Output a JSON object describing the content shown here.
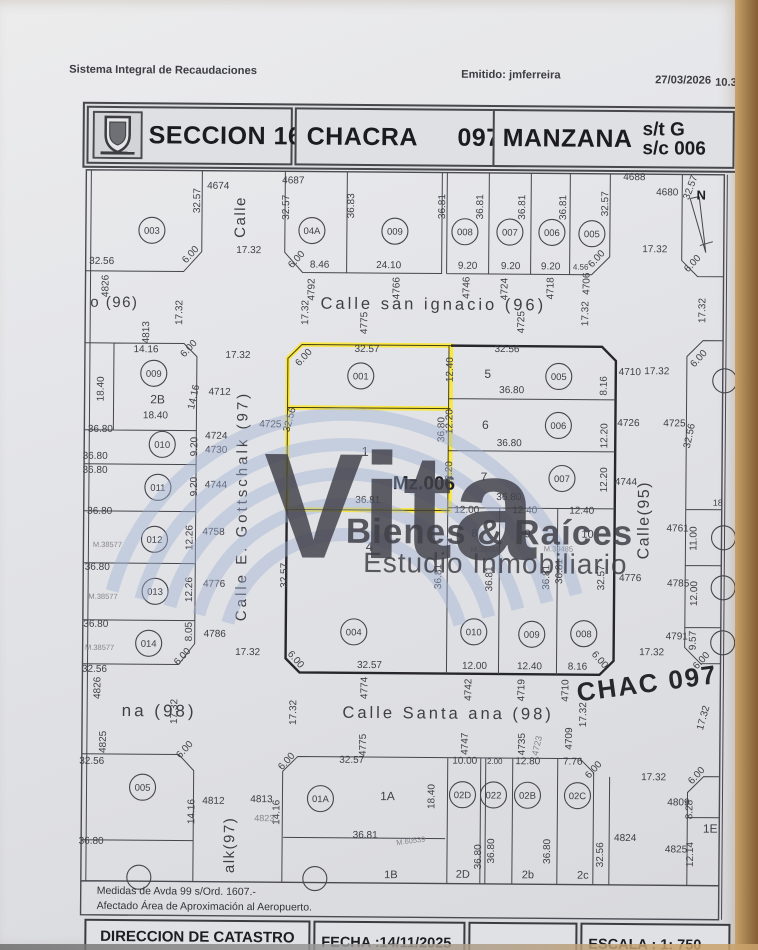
{
  "header": {
    "system": "Sistema Integral de Recaudaciones",
    "emitted": "Emitido: jmferreira",
    "date": "27/03/2026",
    "time": "10.31"
  },
  "title": {
    "seccion_label": "SECCION",
    "seccion_value": "16",
    "chacra_label": "CHACRA",
    "chacra_value": "097",
    "manzana_label": "MANZANA",
    "st": "s/t G",
    "sc": "s/c 006"
  },
  "watermark": {
    "word": "Vita",
    "line1": "Bienes & Raíces",
    "line2": "Estudio Inmobiliario"
  },
  "notes": {
    "line1": "Medidas de Avda 99 s/Ord. 1607.-",
    "line2": "Afectado Área de Aproximación al Aeropuerto."
  },
  "footer": {
    "office": "DIRECCION DE CATASTRO",
    "office_sub": "Información Geográfica",
    "fecha": "FECHA :14/11/2025",
    "escala": "ESCALA :  1:  750"
  },
  "map": {
    "highlight_color": "#ffe818",
    "labels": [
      [
        "32.57",
        198,
        202,
        -90
      ],
      [
        "4674",
        216,
        190
      ],
      [
        "Calle",
        243,
        218,
        -90,
        15,
        "st"
      ],
      [
        "4687",
        291,
        184
      ],
      [
        "32.57",
        287,
        208,
        -90
      ],
      [
        "36.83",
        352,
        206,
        -90
      ],
      [
        "36.81",
        443,
        206,
        -90
      ],
      [
        "36.81",
        481,
        206,
        -90
      ],
      [
        "36.81",
        523,
        206,
        -90
      ],
      [
        "36.81",
        564,
        206,
        -90
      ],
      [
        "32.57",
        606,
        202,
        -90
      ],
      [
        "4688",
        632,
        178
      ],
      [
        "4680",
        665,
        193
      ],
      [
        "N",
        699,
        197,
        0,
        13,
        "b"
      ],
      [
        "32.57",
        691,
        186,
        -70
      ],
      [
        "17.32",
        653,
        250
      ],
      [
        "6.00",
        693,
        263,
        -48
      ],
      [
        "17.32",
        704,
        308,
        -90
      ],
      [
        "6.00",
        191,
        258,
        -48
      ],
      [
        "32.56",
        100,
        266
      ],
      [
        "17.32",
        247,
        254
      ],
      [
        "6.00",
        297,
        262,
        -48
      ],
      [
        "8.46",
        318,
        268
      ],
      [
        "24.10",
        387,
        268
      ],
      [
        "9.20",
        466,
        268
      ],
      [
        "9.20",
        509,
        268
      ],
      [
        "9.20",
        549,
        268
      ],
      [
        "4.56",
        579,
        268,
        0,
        8
      ],
      [
        "6.00",
        597,
        259,
        -48
      ],
      [
        "4826",
        107,
        288,
        -90
      ],
      [
        "o (96)",
        113,
        309,
        0,
        15,
        "st"
      ],
      [
        "17.32",
        181,
        314,
        -90
      ],
      [
        "4792",
        313,
        290,
        -90
      ],
      [
        "17.32",
        307,
        313,
        -90
      ],
      [
        "Calle san ignacio (96)",
        432,
        309,
        0,
        16.5,
        "st2"
      ],
      [
        "4775",
        366,
        323,
        -90
      ],
      [
        "4766",
        398,
        288,
        -90
      ],
      [
        "4746",
        468,
        287,
        -90
      ],
      [
        "4724",
        506,
        288,
        -90
      ],
      [
        "4718",
        552,
        287,
        -90
      ],
      [
        "4706",
        588,
        282,
        -90
      ],
      [
        "17.32",
        587,
        312,
        -90
      ],
      [
        "4725",
        523,
        321,
        -90
      ],
      [
        "14.16",
        145,
        354
      ],
      [
        "17.32",
        237,
        359
      ],
      [
        "4813",
        148,
        334,
        -90
      ],
      [
        "6.00",
        190,
        352,
        -48
      ],
      [
        "6.00",
        305,
        360,
        -48
      ],
      [
        "32.57",
        366,
        352
      ],
      [
        "32.56",
        506,
        351
      ],
      [
        "12.40",
        452,
        369,
        -90
      ],
      [
        "5",
        487,
        377,
        0,
        12
      ],
      [
        "36.80",
        511,
        392
      ],
      [
        "8.16",
        606,
        384,
        -90
      ],
      [
        "4710",
        629,
        373
      ],
      [
        "17.32",
        656,
        372
      ],
      [
        "6.00",
        700,
        358,
        -48
      ],
      [
        "18.40",
        103,
        391,
        -90
      ],
      [
        "14.16",
        196,
        399,
        -78
      ],
      [
        "4712",
        219,
        396
      ],
      [
        "2B",
        157,
        405,
        0,
        12
      ],
      [
        "18.40",
        155,
        420
      ],
      [
        "32.56",
        292,
        421,
        -75
      ],
      [
        "4725",
        270,
        428
      ],
      [
        "36.80",
        444,
        429,
        -90
      ],
      [
        "12.20",
        452,
        421,
        -90
      ],
      [
        "6",
        485,
        428,
        0,
        12
      ],
      [
        "36.80",
        509,
        445
      ],
      [
        "12.20",
        607,
        434,
        -90
      ],
      [
        "4726",
        628,
        424
      ],
      [
        "4725",
        674,
        424
      ],
      [
        "32.56",
        692,
        434,
        -78
      ],
      [
        "36.80",
        100,
        434
      ],
      [
        "9.20",
        197,
        448,
        -90
      ],
      [
        "4724",
        216,
        440
      ],
      [
        "4730",
        216,
        454
      ],
      [
        "36.80",
        95,
        461
      ],
      [
        "36.80",
        95,
        475
      ],
      [
        "12.20",
        452,
        473,
        -90
      ],
      [
        "7",
        484,
        480,
        0,
        12
      ],
      [
        "12.20",
        607,
        478,
        -90
      ],
      [
        "4744",
        626,
        483
      ],
      [
        "9.20",
        197,
        488,
        -90
      ],
      [
        "4744",
        216,
        489
      ],
      [
        "36.80",
        100,
        516
      ],
      [
        "1",
        365,
        456,
        0,
        13
      ],
      [
        "Mz.006",
        424,
        489,
        0,
        19,
        "dk"
      ],
      [
        "36.81",
        368,
        503
      ],
      [
        "36.80",
        509,
        499
      ],
      [
        "12.00",
        467,
        512
      ],
      [
        "12.40",
        525,
        512
      ],
      [
        "12.40",
        582,
        512
      ],
      [
        "Calle E. Gottschalk (97)",
        247,
        507,
        -90,
        15,
        "st2"
      ],
      [
        "Calle(95)",
        649,
        518,
        -90,
        16,
        "st"
      ],
      [
        "8",
        475,
        536,
        0,
        11
      ],
      [
        "9",
        528,
        536,
        0,
        11
      ],
      [
        "10",
        588,
        536,
        0,
        11
      ],
      [
        "M.39488",
        486,
        551,
        0,
        7.5,
        "gy"
      ],
      [
        "M.39485",
        559,
        550,
        0,
        7.5,
        "gy"
      ],
      [
        "4",
        370,
        551,
        0,
        13
      ],
      [
        "32.57",
        288,
        576,
        -90
      ],
      [
        "36.81",
        442,
        576,
        -90
      ],
      [
        "36.81",
        493,
        578,
        -90
      ],
      [
        "36.81",
        550,
        576,
        -90
      ],
      [
        "36.81",
        563,
        570,
        -90
      ],
      [
        "32.57",
        605,
        576,
        -90
      ],
      [
        "M.38577",
        108,
        549,
        0,
        7.5,
        "gy"
      ],
      [
        "12.26",
        193,
        539,
        -90
      ],
      [
        "4758",
        214,
        536
      ],
      [
        "36.80",
        98,
        572
      ],
      [
        "M.38577",
        104,
        601,
        0,
        7.5,
        "gy"
      ],
      [
        "12.26",
        193,
        591,
        -90
      ],
      [
        "4776",
        215,
        588
      ],
      [
        "36.80",
        97,
        629
      ],
      [
        "M.38577",
        101,
        652,
        0,
        7.5,
        "gy"
      ],
      [
        "8.05",
        193,
        633,
        -90
      ],
      [
        "6.00",
        186,
        660,
        -48
      ],
      [
        "4786",
        216,
        638
      ],
      [
        "17.32",
        249,
        656
      ],
      [
        "32.56",
        96,
        674
      ],
      [
        "18",
        718,
        503,
        0,
        9
      ],
      [
        "4761",
        678,
        529
      ],
      [
        "11.00",
        697,
        536,
        -90
      ],
      [
        "4776",
        631,
        579
      ],
      [
        "4785",
        679,
        584
      ],
      [
        "12.00",
        698,
        591,
        -90
      ],
      [
        "4791",
        678,
        637
      ],
      [
        "9.57",
        697,
        638,
        -90
      ],
      [
        "6.00",
        705,
        660,
        -48
      ],
      [
        "17.32",
        653,
        653
      ],
      [
        "6.00",
        295,
        662,
        48
      ],
      [
        "32.57",
        371,
        668
      ],
      [
        "12.00",
        476,
        668
      ],
      [
        "12.40",
        531,
        668
      ],
      [
        "8.16",
        579,
        668
      ],
      [
        "6.00",
        599,
        660,
        48
      ],
      [
        "4774",
        369,
        688,
        -90
      ],
      [
        "4742",
        473,
        689,
        -90
      ],
      [
        "4719",
        526,
        689,
        -90
      ],
      [
        "4710",
        570,
        689,
        -90
      ],
      [
        "17.32",
        298,
        713,
        -90
      ],
      [
        "17.32",
        179,
        713,
        -90
      ],
      [
        "4826",
        102,
        690,
        -90
      ],
      [
        "na (98)",
        161,
        718,
        0,
        17,
        "st2"
      ],
      [
        "Calle Santa ana (98)",
        450,
        718,
        0,
        16.5,
        "st2"
      ],
      [
        "17.32",
        588,
        713,
        -90
      ],
      [
        "CHAC 097",
        650,
        690,
        -8,
        26,
        "dk2"
      ],
      [
        "17.32",
        708,
        716,
        -75
      ],
      [
        "4825",
        108,
        744,
        -90
      ],
      [
        "4775",
        368,
        745,
        -90
      ],
      [
        "4747",
        470,
        743,
        -90
      ],
      [
        "4735",
        527,
        743,
        -90
      ],
      [
        "4723",
        542,
        745,
        -78,
        9,
        "gy"
      ],
      [
        "4709",
        574,
        737,
        -90
      ],
      [
        "32.56",
        94,
        766
      ],
      [
        "32.57",
        354,
        763
      ],
      [
        "10.00",
        467,
        763
      ],
      [
        "2.00",
        497,
        763,
        0,
        8
      ],
      [
        "12.80",
        530,
        763
      ],
      [
        "7.76",
        575,
        763
      ],
      [
        "6.00",
        598,
        770,
        -48
      ],
      [
        "6.00",
        189,
        753,
        -48
      ],
      [
        "6.00",
        291,
        764,
        -48
      ],
      [
        "17.32",
        656,
        778
      ],
      [
        "6.00",
        701,
        775,
        -48
      ],
      [
        "1A",
        390,
        800,
        0,
        12
      ],
      [
        "18.40",
        437,
        796,
        -90
      ],
      [
        "4809",
        681,
        803
      ],
      [
        "8.28",
        695,
        807,
        -90
      ],
      [
        "1E",
        713,
        830,
        0,
        12
      ],
      [
        "4812",
        216,
        805
      ],
      [
        "4813",
        264,
        803
      ],
      [
        "14.16",
        197,
        813,
        -90
      ],
      [
        "14.16",
        282,
        813,
        -90
      ],
      [
        "4823",
        267,
        822,
        0,
        9,
        "gy"
      ],
      [
        "alk(97)",
        237,
        846,
        -90,
        15,
        "st"
      ],
      [
        "36.81",
        368,
        838
      ],
      [
        "M.60539",
        414,
        843,
        -8,
        7.5,
        "gy"
      ],
      [
        "36.80",
        94,
        846
      ],
      [
        "36.80",
        484,
        856,
        -90
      ],
      [
        "36.80",
        497,
        850,
        -90
      ],
      [
        "36.80",
        553,
        850,
        -90
      ],
      [
        "32.56",
        606,
        853,
        -90
      ],
      [
        "4824",
        628,
        839
      ],
      [
        "4825",
        679,
        850
      ],
      [
        "12.14",
        696,
        852,
        -90
      ],
      [
        "2D",
        466,
        877,
        0,
        11
      ],
      [
        "2b",
        531,
        877,
        0,
        11
      ],
      [
        "2c",
        586,
        877,
        0,
        11
      ],
      [
        "1B",
        394,
        878,
        0,
        11
      ]
    ],
    "circles": [
      [
        "003",
        150,
        232
      ],
      [
        "04A",
        310,
        231
      ],
      [
        "009",
        393,
        231
      ],
      [
        "008",
        463,
        231
      ],
      [
        "007",
        508,
        231
      ],
      [
        "006",
        550,
        231
      ],
      [
        "005",
        590,
        232
      ],
      [
        "009",
        153,
        375
      ],
      [
        "010",
        162,
        446
      ],
      [
        "011",
        158,
        489
      ],
      [
        "012",
        155,
        541
      ],
      [
        "013",
        156,
        593
      ],
      [
        "014",
        150,
        645
      ],
      [
        "001",
        360,
        376
      ],
      [
        "005",
        558,
        375
      ],
      [
        "006",
        558,
        424
      ],
      [
        "007",
        562,
        477
      ],
      [
        "004",
        355,
        632
      ],
      [
        "010",
        475,
        631
      ],
      [
        "009",
        533,
        633
      ],
      [
        "008",
        585,
        632
      ],
      [
        "005",
        145,
        789
      ],
      [
        "01A",
        323,
        799
      ],
      [
        "02D",
        465,
        794
      ],
      [
        "022",
        496,
        794
      ],
      [
        "02B",
        530,
        794
      ],
      [
        "02C",
        580,
        794
      ]
    ],
    "partial_circles": [
      [
        724,
        378
      ],
      [
        724,
        535
      ],
      [
        724,
        585
      ],
      [
        724,
        640
      ],
      [
        142,
        879
      ],
      [
        318,
        879
      ]
    ]
  }
}
